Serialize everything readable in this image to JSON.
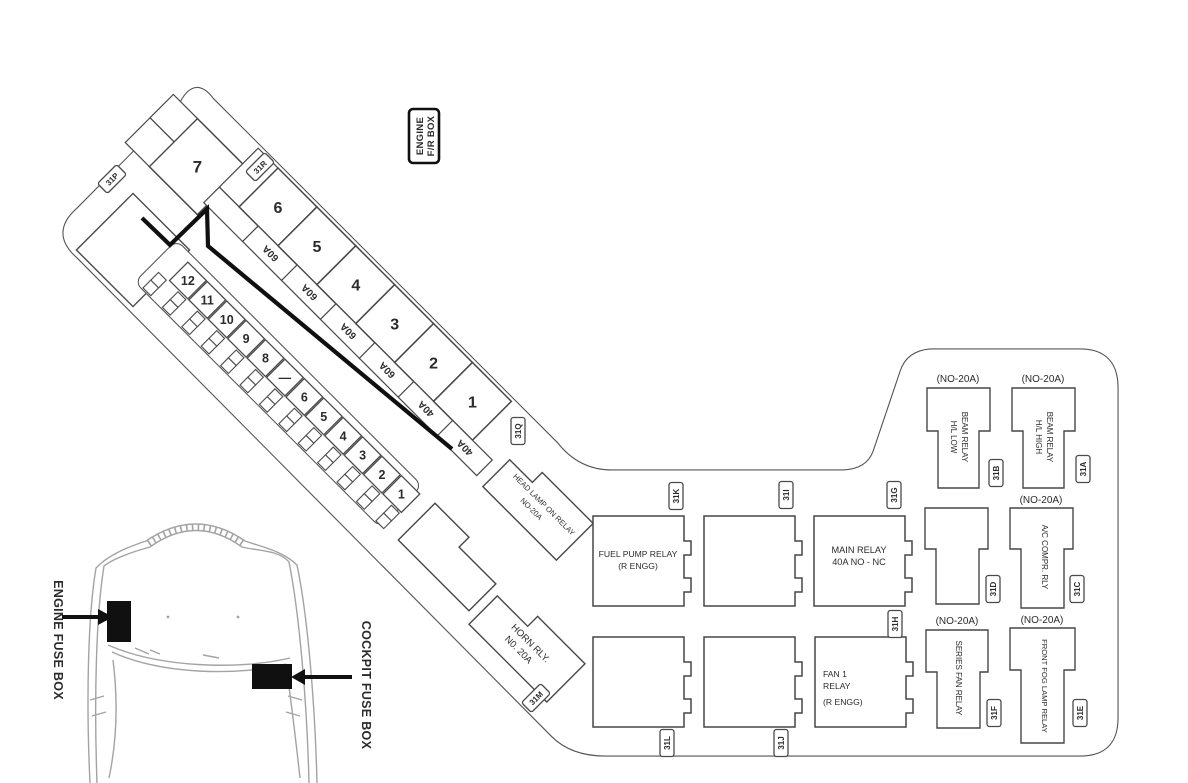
{
  "diagram_title": {
    "line1": "ENGINE",
    "line2": "F/R BOX"
  },
  "large_fuses": {
    "top_fuse": "7",
    "row": [
      {
        "no": "6",
        "rating": "60A"
      },
      {
        "no": "5",
        "rating": "60A"
      },
      {
        "no": "4",
        "rating": "60A"
      },
      {
        "no": "3",
        "rating": "60A"
      },
      {
        "no": "2",
        "rating": "40A"
      },
      {
        "no": "1",
        "rating": "40A"
      }
    ]
  },
  "small_fuses": [
    "12",
    "11",
    "10",
    "9",
    "8",
    "—",
    "6",
    "5",
    "4",
    "3",
    "2",
    "1"
  ],
  "connectors": {
    "a": "31A",
    "b": "31B",
    "c": "31C",
    "d": "31D",
    "e": "31E",
    "f": "31F",
    "g": "31G",
    "h": "31H",
    "i": "31I",
    "j": "31J",
    "k": "31K",
    "l": "31L",
    "m": "31M",
    "p": "31P",
    "q": "31Q",
    "r": "31R"
  },
  "relays": {
    "head_lamp_on": {
      "line1": "HEAD LAMP ON RELAY",
      "line2": "NO-20A"
    },
    "horn": {
      "line1": "HORN RLY.",
      "line2": "N0. 20A"
    },
    "fuel_pump": {
      "line1": "FUEL PUMP RELAY",
      "line2": "(R ENGG)"
    },
    "main": {
      "line1": "MAIN RELAY",
      "line2": "40A NO - NC"
    },
    "fan1": {
      "line1": "FAN 1",
      "line2": "RELAY",
      "line3": "(R ENGG)"
    },
    "hl_low": {
      "amp": "(NO-20A)",
      "line1": "H/L LOW",
      "line2": "BEAM RELAY"
    },
    "hl_high": {
      "amp": "(NO-20A)",
      "line1": "H/L HIGH",
      "line2": "BEAM RELAY"
    },
    "ac_compr": {
      "amp": "(NO-20A)",
      "line1": "A/C COMPR. RLY"
    },
    "series_fan": {
      "amp": "(NO-20A)",
      "line1": "SERIES FAN RELAY"
    },
    "front_fog": {
      "amp": "(NO-20A)",
      "line1": "FRONT FOG LAMP RELAY"
    }
  },
  "car_inset": {
    "engine_label": "ENGINE FUSE BOX",
    "cockpit_label": "COCKPIT FUSE BOX"
  },
  "colors": {
    "line": "#545454",
    "cell": "#474747",
    "dark": "#101010",
    "car_line": "#a3a3a3",
    "text": "#2b2b2b"
  }
}
